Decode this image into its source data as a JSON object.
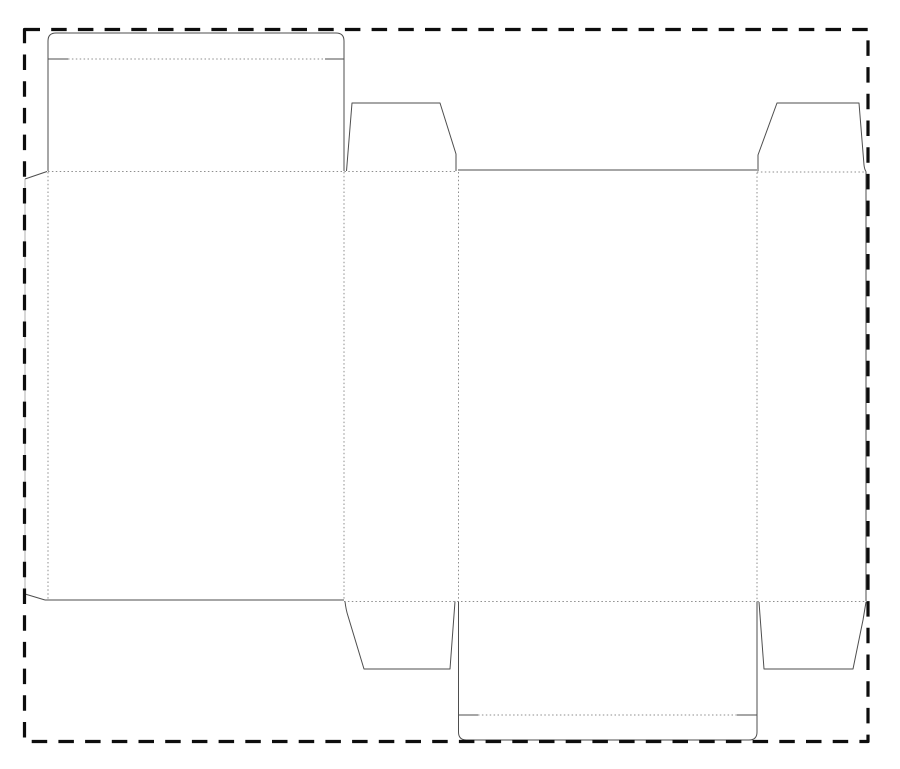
{
  "document": {
    "kind": "packaging-dieline",
    "description": "tuck-end carton dieline with bleed border, no visible text"
  },
  "canvas": {
    "width": 900,
    "height": 769,
    "background": "#ffffff"
  },
  "style": {
    "cut_color": "#4e4e4e",
    "cut_width": 1,
    "crease_color": "#8e8e8e",
    "crease_width": 1,
    "crease_dash": "1.5 2.4",
    "glue_edge_color": "#b2b2b2",
    "border_color": "#0d0d0d",
    "border_width": 3.2,
    "border_dash": "15.5 11.2"
  },
  "bleed_border": {
    "name": "bleed-border",
    "path": "M 24.5,29.5 L 868,29.5 L 868,741.5 L 24.5,741.5 Z"
  },
  "dieline": {
    "cuts": [
      {
        "name": "glue-flap-top-edge",
        "path": "M 25,179 L 47,171.5"
      },
      {
        "name": "glue-flap-left-edge",
        "path": "M 25,179 L 25,594",
        "light": true
      },
      {
        "name": "glue-flap-bottom-edge",
        "path": "M 25,594 L 45,600"
      },
      {
        "name": "back-panel-bottom-edge",
        "path": "M 45,600 L 344,600"
      },
      {
        "name": "top-closure-outline",
        "path": "M 48,171 L 48,41 Q 48,33 56,33 L 336,33 Q 344,33 344,41 L 344,171"
      },
      {
        "name": "top-tuck-slit-left",
        "path": "M 48,59 L 68,59"
      },
      {
        "name": "top-tuck-slit-right",
        "path": "M 325,59 L 344,59"
      },
      {
        "name": "dust-flap-top-left-cut",
        "path": "M 346.5,171 L 352,103 L 440,103 L 456,154 L 456,171"
      },
      {
        "name": "front-panel-top-edge",
        "path": "M 458,170 L 757,170"
      },
      {
        "name": "dust-flap-top-right-cut",
        "path": "M 758,171 L 758,155 L 777,103 L 859,103 L 864,165 Q 864.5,169.5 866,171.5"
      },
      {
        "name": "side-panel-right-edge",
        "path": "M 866,171.5 L 866,601"
      },
      {
        "name": "dust-flap-bottom-left-cut",
        "path": "M 345,601.5 Q 346,610 348,616 L 364,669 L 450,669 L 455,601.5"
      },
      {
        "name": "dust-flap-bottom-right-cut",
        "path": "M 759,602 L 764,669 L 853,669 L 863,620 Q 865,608 866,602"
      },
      {
        "name": "bottom-closure-left-edge",
        "path": "M 458.5,601.5 L 458.5,732 Q 458.5,740 466.5,740"
      },
      {
        "name": "bottom-closure-right-edge",
        "path": "M 757,601.5 L 757,732 Q 757,740 749,740"
      },
      {
        "name": "bottom-tuck-flap-bottom-edge",
        "path": "M 466.5,740 L 749,740"
      },
      {
        "name": "bottom-tuck-slit-left",
        "path": "M 458.5,715 L 478,715"
      },
      {
        "name": "bottom-tuck-slit-right",
        "path": "M 737,715 L 757,715"
      }
    ],
    "creases": [
      {
        "name": "fold-top-left-row",
        "path": "M 48,171.5 L 457,171.5"
      },
      {
        "name": "fold-top-right-row",
        "path": "M 757,172 L 865,172"
      },
      {
        "name": "fold-bottom-row",
        "path": "M 344,601.5 L 866,601.5"
      },
      {
        "name": "crease-glueflap-back",
        "path": "M 48,172 L 48,600"
      },
      {
        "name": "crease-back-side",
        "path": "M 344,172 L 344,601"
      },
      {
        "name": "crease-side-front",
        "path": "M 458.5,172 L 458.5,601"
      },
      {
        "name": "crease-front-side",
        "path": "M 757,172.5 L 757,601"
      },
      {
        "name": "top-tuck-fold",
        "path": "M 68,59 L 325,59"
      },
      {
        "name": "bottom-tuck-fold",
        "path": "M 478,715 L 737,715"
      }
    ],
    "panels": [
      {
        "name": "glue-flap",
        "x": 25,
        "y": 172,
        "w": 23,
        "h": 426
      },
      {
        "name": "top-tuck-flap",
        "x": 48,
        "y": 33,
        "w": 296,
        "h": 26
      },
      {
        "name": "top-panel",
        "x": 48,
        "y": 59,
        "w": 296,
        "h": 112
      },
      {
        "name": "back-panel",
        "x": 48,
        "y": 171,
        "w": 296,
        "h": 429
      },
      {
        "name": "side-panel-left",
        "x": 344,
        "y": 171,
        "w": 114,
        "h": 430
      },
      {
        "name": "dust-flap-top-left",
        "x": 346,
        "y": 103,
        "w": 110,
        "h": 68
      },
      {
        "name": "front-panel",
        "x": 458,
        "y": 170,
        "w": 299,
        "h": 431
      },
      {
        "name": "dust-flap-top-right",
        "x": 757,
        "y": 103,
        "w": 109,
        "h": 69
      },
      {
        "name": "side-panel-right",
        "x": 757,
        "y": 172,
        "w": 109,
        "h": 429
      },
      {
        "name": "dust-flap-bottom-left",
        "x": 345,
        "y": 601,
        "w": 110,
        "h": 68
      },
      {
        "name": "dust-flap-bottom-right",
        "x": 759,
        "y": 602,
        "w": 107,
        "h": 67
      },
      {
        "name": "bottom-panel",
        "x": 458,
        "y": 601,
        "w": 299,
        "h": 114
      },
      {
        "name": "bottom-tuck-flap",
        "x": 458,
        "y": 715,
        "w": 299,
        "h": 25
      }
    ]
  }
}
